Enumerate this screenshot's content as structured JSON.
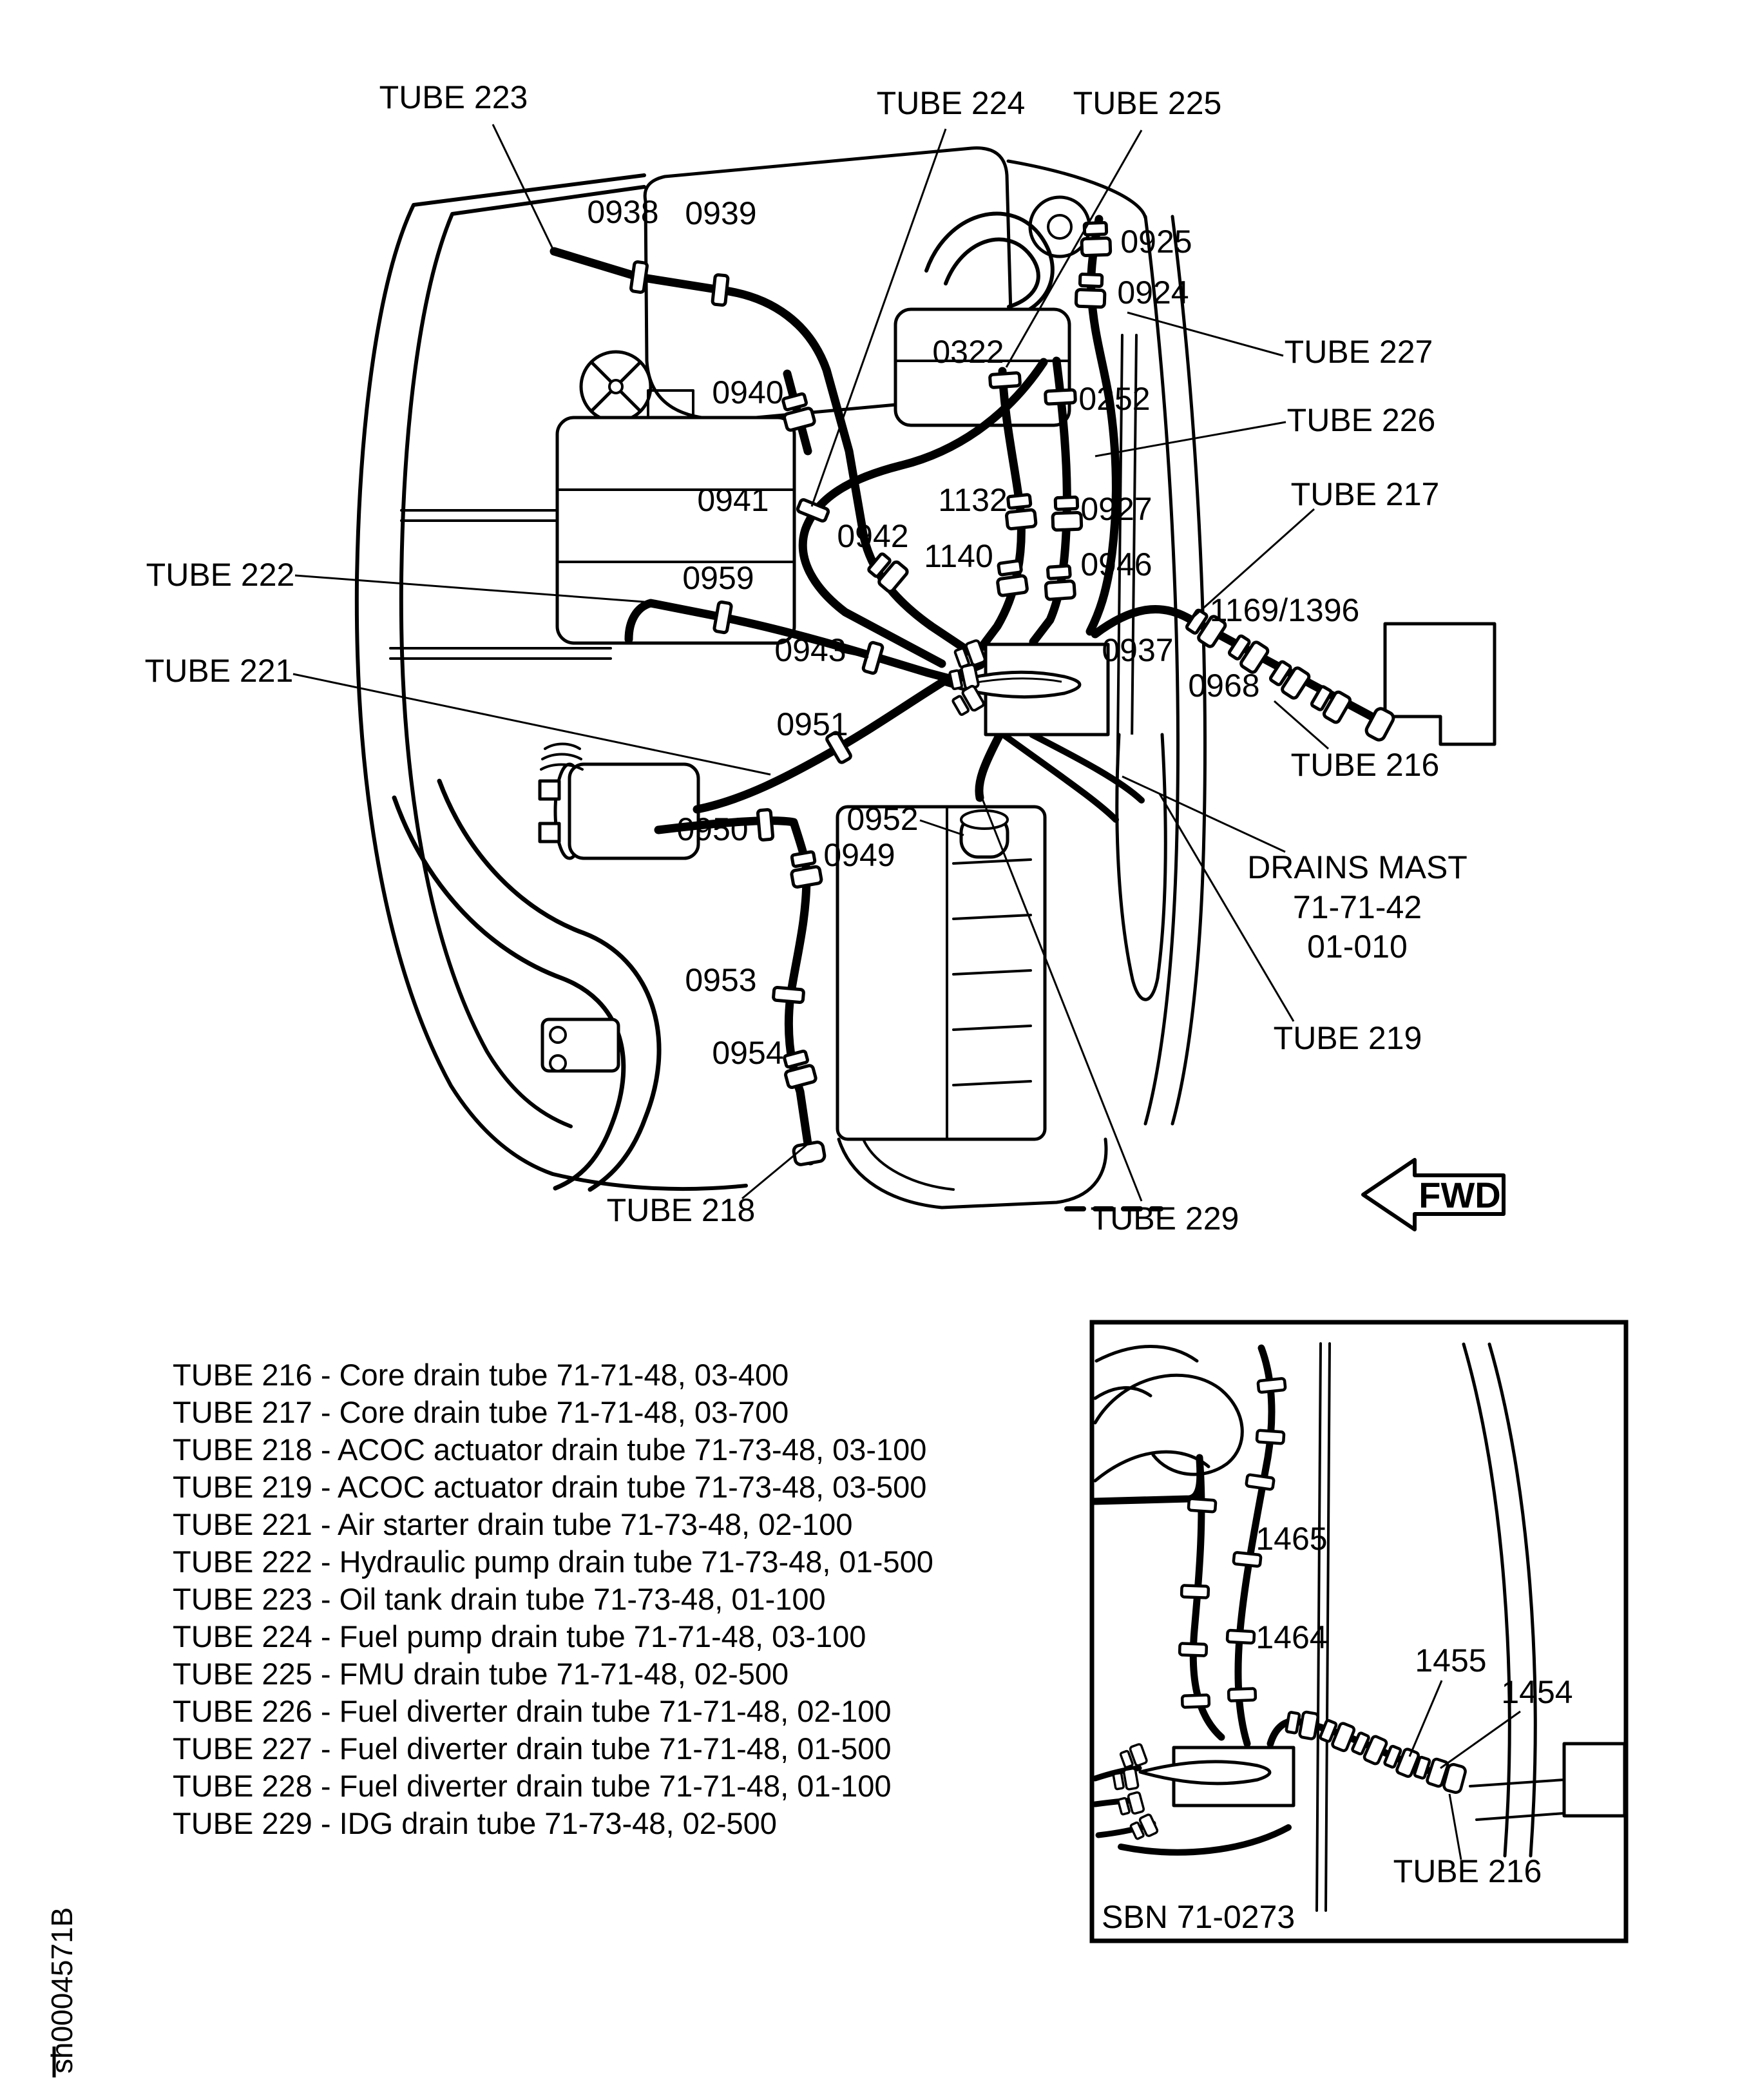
{
  "page": {
    "background_color": "#ffffff",
    "ink_color": "#000000"
  },
  "main_diagram": {
    "tube_callouts": {
      "tube223": "TUBE 223",
      "tube224": "TUBE 224",
      "tube225": "TUBE 225",
      "tube227": "TUBE 227",
      "tube226": "TUBE 226",
      "tube217": "TUBE 217",
      "tube222": "TUBE 222",
      "tube221": "TUBE 221",
      "tube216": "TUBE 216",
      "tube219": "TUBE 219",
      "tube218": "TUBE 218",
      "tube229": "TUBE 229"
    },
    "part_numbers": {
      "p0938": "0938",
      "p0939": "0939",
      "p0925": "0925",
      "p0924": "0924",
      "p0322": "0322",
      "p0252": "0252",
      "p0940": "0940",
      "p0941": "0941",
      "p1132": "1132",
      "p0927": "0927",
      "p0942": "0942",
      "p1140": "1140",
      "p0946": "0946",
      "p0959": "0959",
      "p1169_1396": "1169/1396",
      "p0937": "0937",
      "p0943": "0943",
      "p0968": "0968",
      "p0951": "0951",
      "p0950": "0950",
      "p0952": "0952",
      "p0949": "0949",
      "p0953": "0953",
      "p0954": "0954"
    },
    "drains_mast": {
      "line1": "DRAINS MAST",
      "line2": "71-71-42",
      "line3": "01-010"
    },
    "fwd_arrow_label": "FWD"
  },
  "legend": {
    "items": [
      "TUBE 216 - Core drain tube 71-71-48, 03-400",
      "TUBE 217 - Core drain tube 71-71-48, 03-700",
      "TUBE 218 - ACOC actuator drain tube 71-73-48, 03-100",
      "TUBE 219 - ACOC actuator drain tube 71-73-48, 03-500",
      "TUBE 221 - Air starter drain tube 71-73-48, 02-100",
      "TUBE 222 - Hydraulic pump drain tube 71-73-48, 01-500",
      "TUBE 223 - Oil tank drain tube 71-73-48, 01-100",
      "TUBE 224 - Fuel pump drain tube 71-71-48, 03-100",
      "TUBE 225 - FMU drain tube 71-71-48, 02-500",
      "TUBE 226 - Fuel diverter drain tube 71-71-48, 02-100",
      "TUBE 227 - Fuel diverter drain tube 71-71-48, 01-500",
      "TUBE 228 - Fuel diverter drain tube 71-71-48, 01-100",
      "TUBE 229 - IDG drain tube 71-73-48, 02-500"
    ]
  },
  "inset": {
    "part_numbers": {
      "p1465": "1465",
      "p1464": "1464",
      "p1455": "1455",
      "p1454": "1454"
    },
    "tube_callout": "TUBE 216",
    "caption": "SBN 71-0273"
  },
  "sheet_code": "sh0004571B"
}
